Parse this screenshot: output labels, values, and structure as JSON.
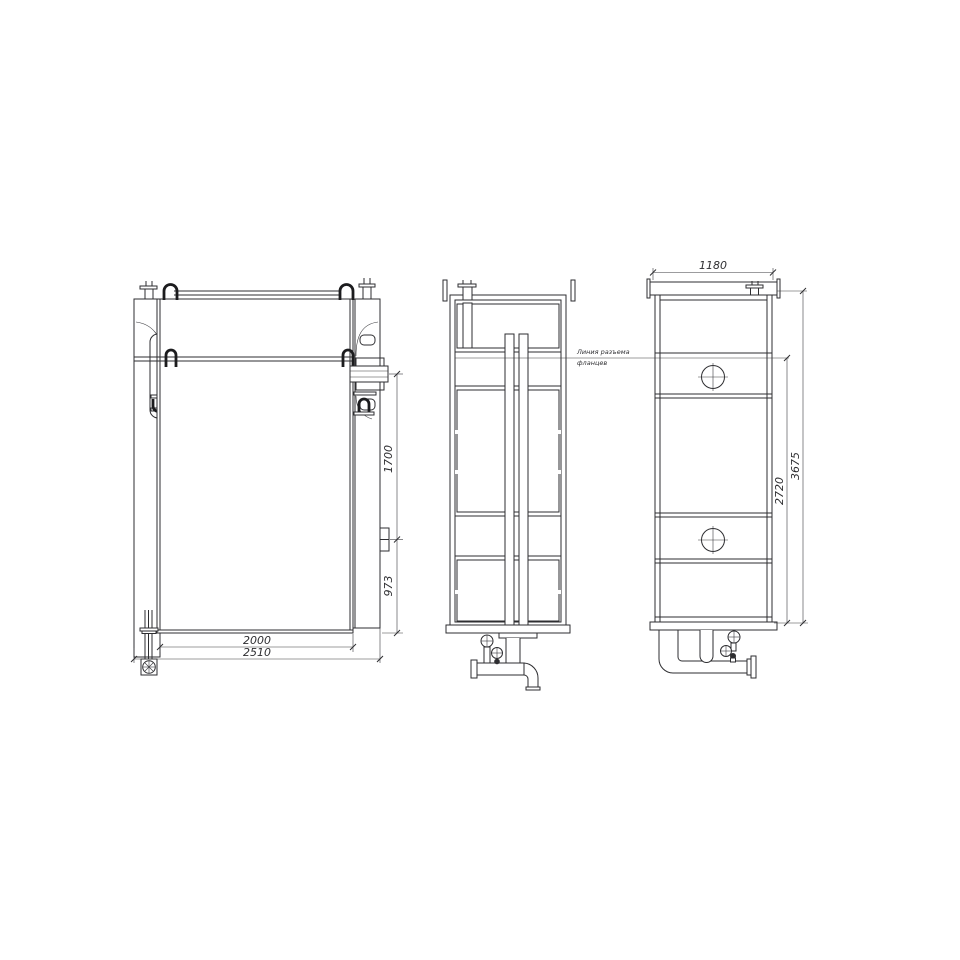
{
  "drawing": {
    "background": "#ffffff",
    "ink_color": "#2e2e31",
    "dimensions": {
      "inner_width": "2000",
      "outer_width": "2510",
      "nozzle_height": "1700",
      "lower_height": "973",
      "side_width": "1180",
      "flange_height": "2720",
      "overall_height": "3675"
    },
    "annotation": {
      "line1": "Линия разъема",
      "line2": "фланцев"
    },
    "symbols": {
      "manhole": "circle-with-crosshair",
      "valve": "handwheel-circle",
      "drain": "boxed-circle-cross",
      "element_block": "hatched-heating-element-grid"
    }
  }
}
